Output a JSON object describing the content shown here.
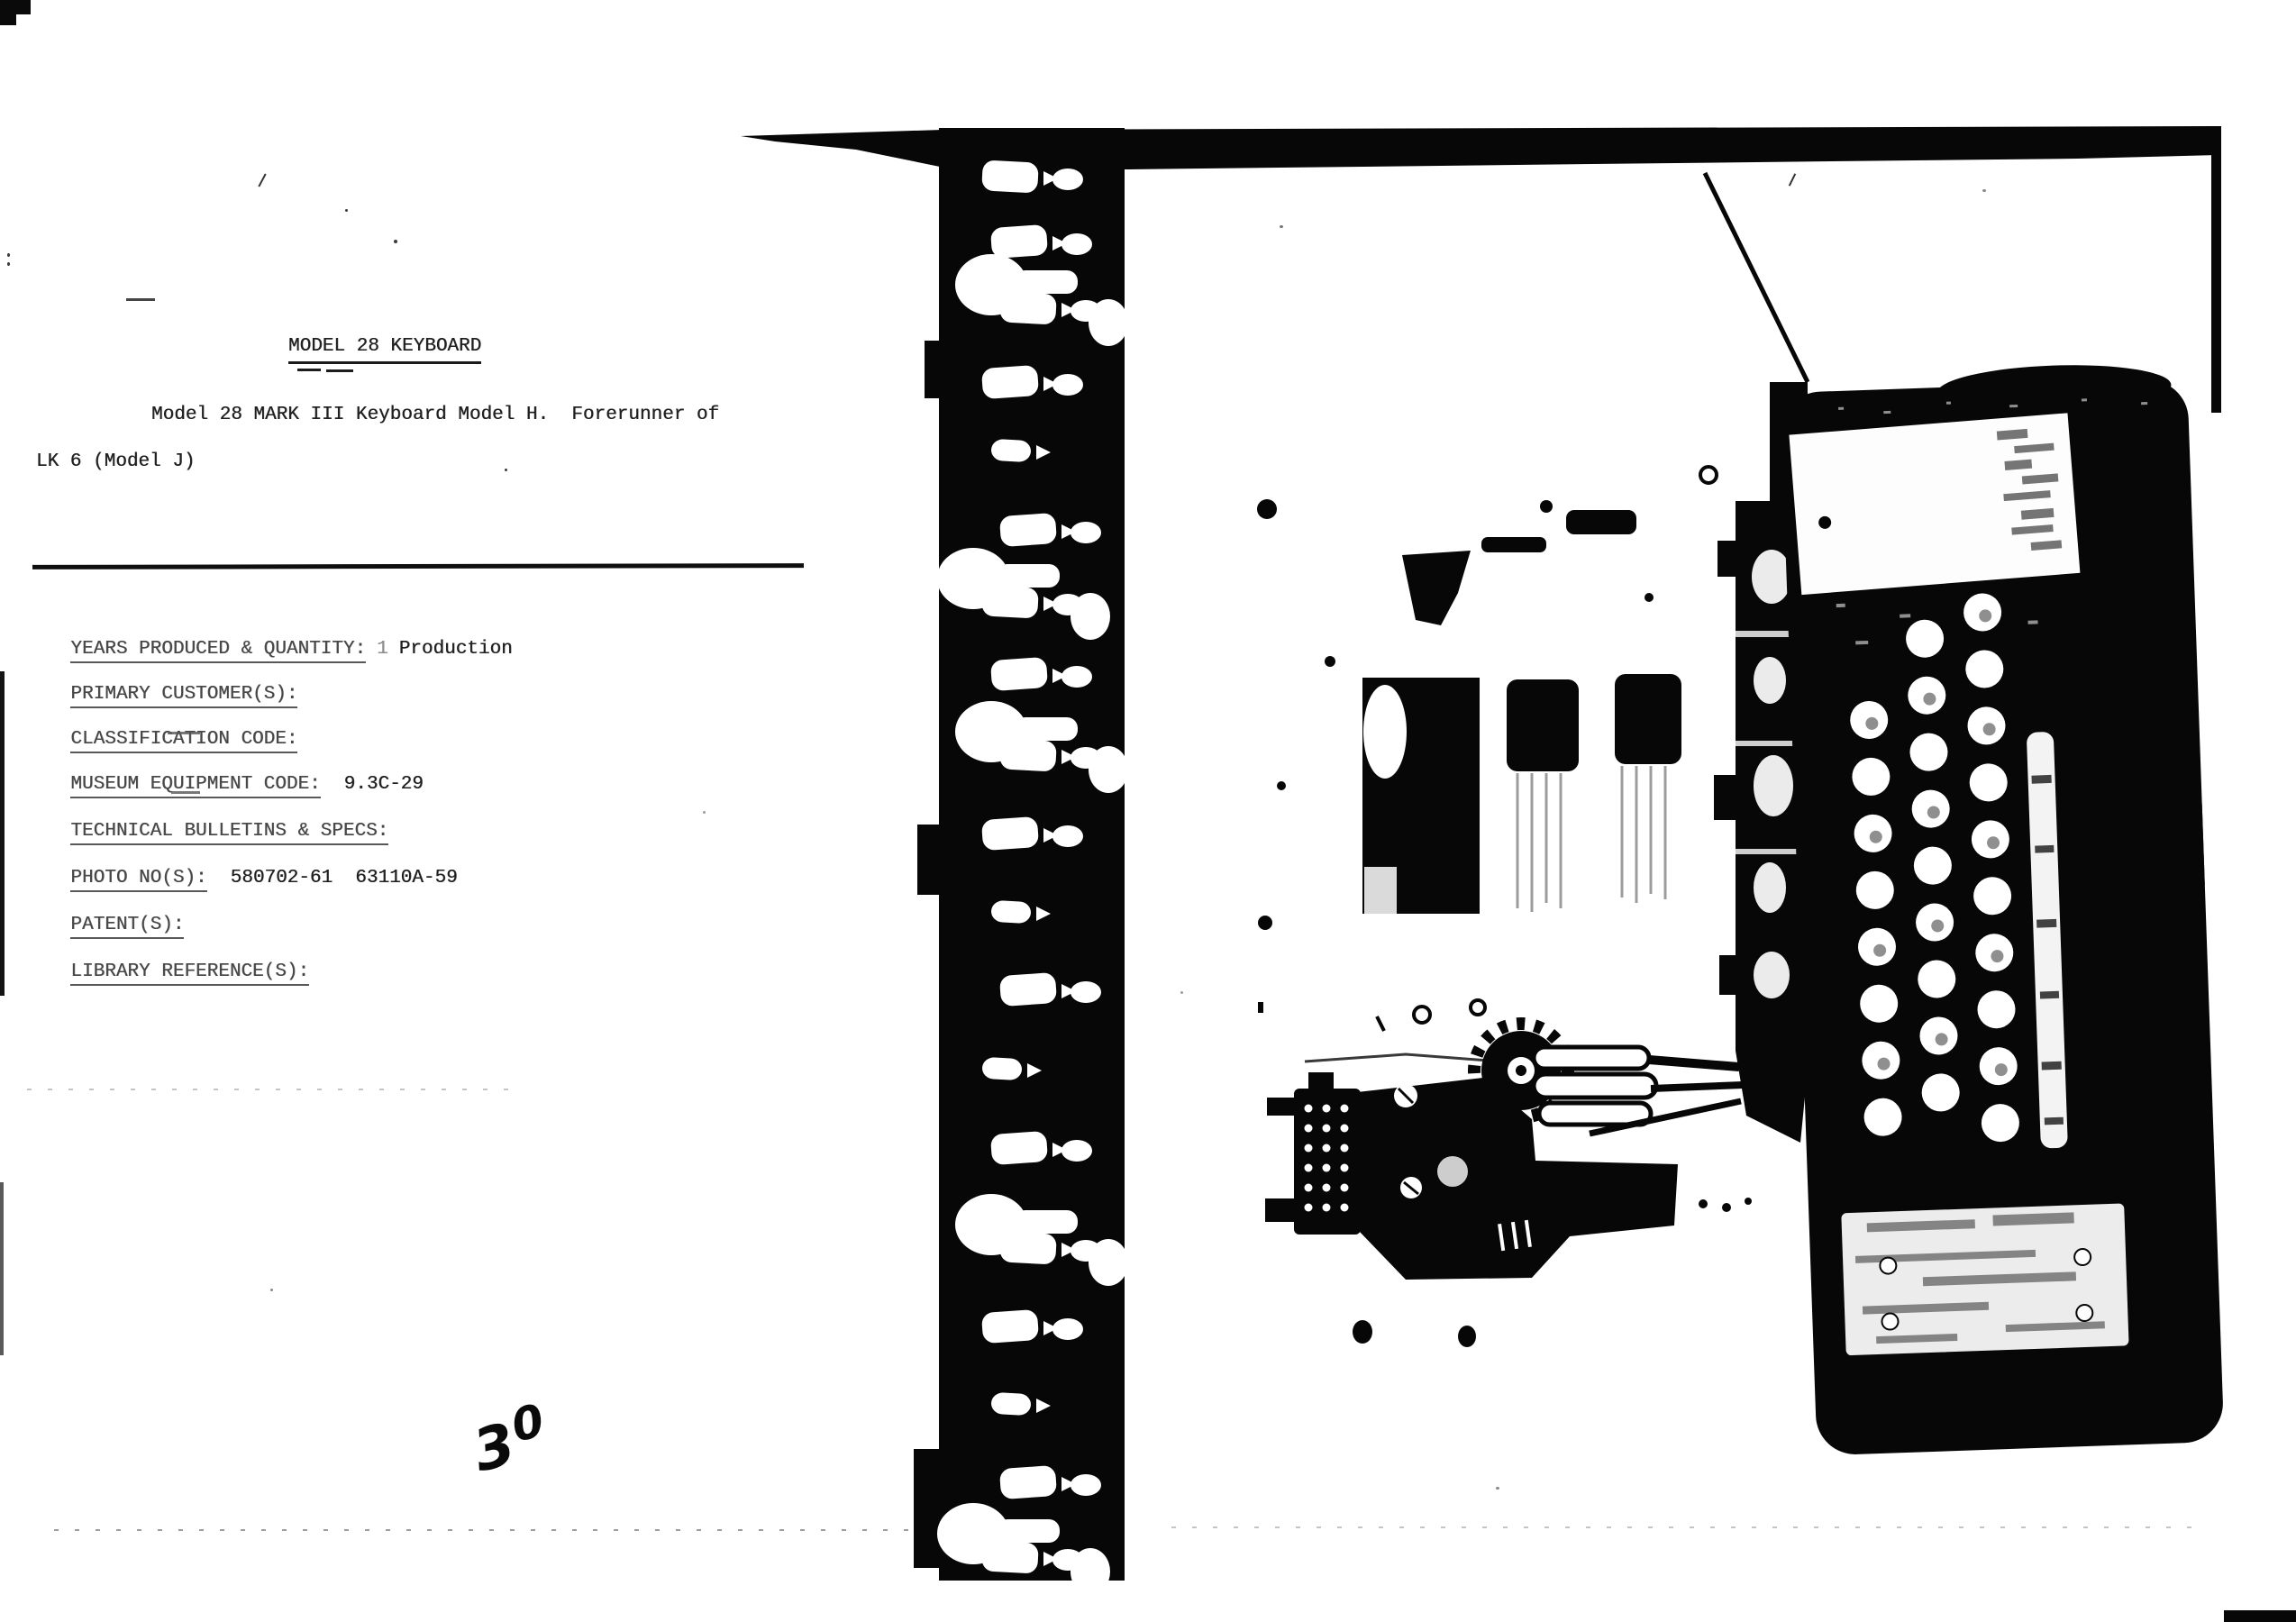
{
  "document": {
    "title": "MODEL 28 KEYBOARD",
    "intro_line1": "Model 28 MARK III Keyboard Model H.  Forerunner of",
    "intro_line2": "LK 6 (Model J)",
    "fields": [
      {
        "label": "YEARS PRODUCED & QUANTITY:",
        "mark": "1",
        "value": "Production"
      },
      {
        "label": "PRIMARY CUSTOMER(S):",
        "value": ""
      },
      {
        "label": "CLASSIFICATION CODE:",
        "value": ""
      },
      {
        "label": "MUSEUM EQUIPMENT CODE:",
        "value": "9.3C-29"
      },
      {
        "label": "TECHNICAL BULLETINS & SPECS:",
        "value": ""
      },
      {
        "label": "PHOTO NO(S):",
        "value": "580702-61  63110A-59"
      },
      {
        "label": "PATENT(S):",
        "value": ""
      },
      {
        "label": "LIBRARY REFERENCE(S):",
        "value": ""
      }
    ],
    "handwritten_page_number": "30",
    "handwritten_digits": {
      "first": "3",
      "second": "0"
    }
  },
  "figure": {
    "description": "High-contrast photocopy of a photograph showing a Model 28 MARK III keyboard unit lying on its side: chassis plate with slots at left, drive gear and motor below, dark keyboard case with round keys, name plate and base plate at right; spiral-binding film strip runs vertically between the text page and the photo page.",
    "ink_color": "#070707",
    "paper_color": "#ffffff"
  }
}
